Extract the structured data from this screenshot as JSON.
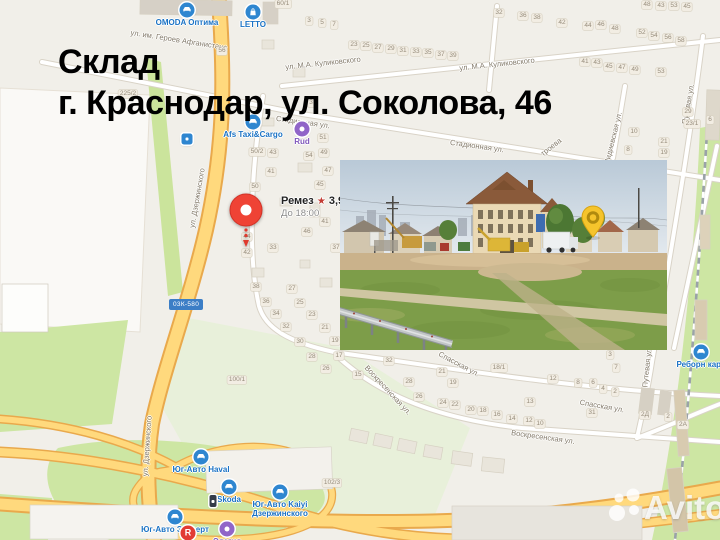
{
  "title": {
    "line1": "Склад",
    "line2": "г. Краснодар, ул. Соколова, 46"
  },
  "watermark": {
    "brand": "Avito"
  },
  "map": {
    "road_badge": "03К-580",
    "pin": {
      "name": "Ремез",
      "star": "★",
      "rating": "3,9",
      "hours": "До 18:00"
    },
    "colors": {
      "title": "#000000",
      "pin_red": "#ef4335",
      "poi_blue": "#2e86d0",
      "poi_purple": "#9065c8",
      "poi_red": "#e23b33",
      "stop_dark": "#333c49",
      "road_yellow": "#ffd97d",
      "road_casing": "#e9a94c",
      "green": "#cde6a3",
      "green_pale": "#e8f0da",
      "badge_blue": "#3c7ec6",
      "building": "#e9e5db"
    },
    "street_labels": [
      {
        "text": "ул. им. Героев Афганистана",
        "x": 179,
        "y": 40,
        "rot": 9
      },
      {
        "text": "ул. М.А. Куликовского",
        "x": 323,
        "y": 63,
        "rot": -6
      },
      {
        "text": "ул. М.А. Куликовского",
        "x": 497,
        "y": 64,
        "rot": -6
      },
      {
        "text": "Стадионная ул.",
        "x": 303,
        "y": 122,
        "rot": 8
      },
      {
        "text": "Стадионная ул.",
        "x": 477,
        "y": 146,
        "rot": 8
      },
      {
        "text": "троева",
        "x": 551,
        "y": 147,
        "rot": -38
      },
      {
        "text": "ул. Дзержинского",
        "x": 197,
        "y": 198,
        "rot": -80
      },
      {
        "text": "ул. Дзержинского",
        "x": 147,
        "y": 446,
        "rot": -86
      },
      {
        "text": "Спасская ул.",
        "x": 459,
        "y": 364,
        "rot": 28
      },
      {
        "text": "Спасская ул.",
        "x": 602,
        "y": 406,
        "rot": 10
      },
      {
        "text": "Воскресенская ул.",
        "x": 388,
        "y": 390,
        "rot": 47
      },
      {
        "text": "Воскресенская ул.",
        "x": 543,
        "y": 437,
        "rot": 8
      },
      {
        "text": "Путевая ул.",
        "x": 688,
        "y": 104,
        "rot": -80
      },
      {
        "text": "Путевая ул.",
        "x": 647,
        "y": 367,
        "rot": -84
      },
      {
        "text": "Лидиевская ул.",
        "x": 613,
        "y": 138,
        "rot": -76
      }
    ],
    "house_numbers": [
      {
        "t": "60/1",
        "x": 283,
        "y": 4
      },
      {
        "t": "56",
        "x": 222,
        "y": 51
      },
      {
        "t": "225/2",
        "x": 128,
        "y": 94
      },
      {
        "t": "3",
        "x": 309,
        "y": 21
      },
      {
        "t": "5",
        "x": 322,
        "y": 23
      },
      {
        "t": "7",
        "x": 334,
        "y": 25
      },
      {
        "t": "23",
        "x": 354,
        "y": 45
      },
      {
        "t": "25",
        "x": 366,
        "y": 46
      },
      {
        "t": "27",
        "x": 378,
        "y": 48
      },
      {
        "t": "29",
        "x": 391,
        "y": 49
      },
      {
        "t": "31",
        "x": 403,
        "y": 51
      },
      {
        "t": "33",
        "x": 416,
        "y": 52
      },
      {
        "t": "35",
        "x": 428,
        "y": 53
      },
      {
        "t": "37",
        "x": 441,
        "y": 55
      },
      {
        "t": "39",
        "x": 453,
        "y": 56
      },
      {
        "t": "32",
        "x": 499,
        "y": 13
      },
      {
        "t": "36",
        "x": 523,
        "y": 16
      },
      {
        "t": "38",
        "x": 537,
        "y": 18
      },
      {
        "t": "42",
        "x": 562,
        "y": 23
      },
      {
        "t": "44",
        "x": 588,
        "y": 26
      },
      {
        "t": "46",
        "x": 601,
        "y": 25
      },
      {
        "t": "48",
        "x": 615,
        "y": 29
      },
      {
        "t": "52",
        "x": 642,
        "y": 33
      },
      {
        "t": "54",
        "x": 654,
        "y": 36
      },
      {
        "t": "56",
        "x": 668,
        "y": 38
      },
      {
        "t": "58",
        "x": 681,
        "y": 41
      },
      {
        "t": "48",
        "x": 647,
        "y": 5
      },
      {
        "t": "43",
        "x": 661,
        "y": 6
      },
      {
        "t": "53",
        "x": 674,
        "y": 6
      },
      {
        "t": "45",
        "x": 687,
        "y": 7
      },
      {
        "t": "41",
        "x": 585,
        "y": 62
      },
      {
        "t": "43",
        "x": 597,
        "y": 63
      },
      {
        "t": "45",
        "x": 609,
        "y": 67
      },
      {
        "t": "47",
        "x": 622,
        "y": 68
      },
      {
        "t": "49",
        "x": 635,
        "y": 70
      },
      {
        "t": "53",
        "x": 661,
        "y": 72
      },
      {
        "t": "29",
        "x": 688,
        "y": 112
      },
      {
        "t": "23/1",
        "x": 692,
        "y": 124
      },
      {
        "t": "10",
        "x": 634,
        "y": 132
      },
      {
        "t": "21",
        "x": 664,
        "y": 142
      },
      {
        "t": "8",
        "x": 628,
        "y": 150
      },
      {
        "t": "19",
        "x": 664,
        "y": 153
      },
      {
        "t": "6",
        "x": 710,
        "y": 120
      },
      {
        "t": "3",
        "x": 311,
        "y": 103
      },
      {
        "t": "50/2",
        "x": 257,
        "y": 152
      },
      {
        "t": "43",
        "x": 273,
        "y": 153
      },
      {
        "t": "41",
        "x": 271,
        "y": 172
      },
      {
        "t": "50",
        "x": 255,
        "y": 187
      },
      {
        "t": "44",
        "x": 247,
        "y": 237
      },
      {
        "t": "42",
        "x": 247,
        "y": 253
      },
      {
        "t": "33",
        "x": 273,
        "y": 248
      },
      {
        "t": "46",
        "x": 307,
        "y": 232
      },
      {
        "t": "41",
        "x": 325,
        "y": 222
      },
      {
        "t": "45",
        "x": 320,
        "y": 185
      },
      {
        "t": "47",
        "x": 328,
        "y": 171
      },
      {
        "t": "49",
        "x": 324,
        "y": 153
      },
      {
        "t": "51",
        "x": 323,
        "y": 138
      },
      {
        "t": "37",
        "x": 336,
        "y": 248
      },
      {
        "t": "54",
        "x": 309,
        "y": 156
      },
      {
        "t": "38",
        "x": 256,
        "y": 287
      },
      {
        "t": "36",
        "x": 266,
        "y": 302
      },
      {
        "t": "34",
        "x": 276,
        "y": 314
      },
      {
        "t": "32",
        "x": 286,
        "y": 327
      },
      {
        "t": "30",
        "x": 300,
        "y": 342
      },
      {
        "t": "28",
        "x": 312,
        "y": 357
      },
      {
        "t": "26",
        "x": 326,
        "y": 369
      },
      {
        "t": "27",
        "x": 292,
        "y": 289
      },
      {
        "t": "25",
        "x": 300,
        "y": 303
      },
      {
        "t": "23",
        "x": 312,
        "y": 315
      },
      {
        "t": "21",
        "x": 325,
        "y": 328
      },
      {
        "t": "19",
        "x": 335,
        "y": 341
      },
      {
        "t": "17",
        "x": 339,
        "y": 356
      },
      {
        "t": "100/1",
        "x": 237,
        "y": 380
      },
      {
        "t": "32",
        "x": 389,
        "y": 361
      },
      {
        "t": "28",
        "x": 409,
        "y": 382
      },
      {
        "t": "26",
        "x": 419,
        "y": 397
      },
      {
        "t": "21",
        "x": 442,
        "y": 372
      },
      {
        "t": "19",
        "x": 453,
        "y": 383
      },
      {
        "t": "24",
        "x": 443,
        "y": 403
      },
      {
        "t": "22",
        "x": 455,
        "y": 405
      },
      {
        "t": "20",
        "x": 471,
        "y": 410
      },
      {
        "t": "18",
        "x": 483,
        "y": 411
      },
      {
        "t": "16",
        "x": 497,
        "y": 415
      },
      {
        "t": "14",
        "x": 512,
        "y": 419
      },
      {
        "t": "12",
        "x": 529,
        "y": 421
      },
      {
        "t": "10",
        "x": 540,
        "y": 424
      },
      {
        "t": "13",
        "x": 530,
        "y": 402
      },
      {
        "t": "15",
        "x": 358,
        "y": 375
      },
      {
        "t": "18/1",
        "x": 499,
        "y": 368
      },
      {
        "t": "12",
        "x": 553,
        "y": 379
      },
      {
        "t": "8",
        "x": 578,
        "y": 383
      },
      {
        "t": "6",
        "x": 593,
        "y": 383
      },
      {
        "t": "4",
        "x": 603,
        "y": 389
      },
      {
        "t": "2",
        "x": 615,
        "y": 392
      },
      {
        "t": "3",
        "x": 610,
        "y": 355
      },
      {
        "t": "7",
        "x": 616,
        "y": 368
      },
      {
        "t": "31",
        "x": 592,
        "y": 413
      },
      {
        "t": "2Д",
        "x": 645,
        "y": 415
      },
      {
        "t": "2",
        "x": 668,
        "y": 417
      },
      {
        "t": "2А",
        "x": 683,
        "y": 425
      },
      {
        "t": "102/3",
        "x": 332,
        "y": 483
      }
    ],
    "pois": [
      {
        "label": "OMODA Оптима",
        "x": 187,
        "y": 10,
        "color": "blue",
        "glyph": "car"
      },
      {
        "label": "LETTO",
        "x": 253,
        "y": 12,
        "color": "blue",
        "glyph": "bag"
      },
      {
        "label": "Afs Taxi&Cargo",
        "x": 253,
        "y": 122,
        "color": "blue",
        "glyph": "car"
      },
      {
        "label": "Rud",
        "x": 302,
        "y": 129,
        "color": "purple",
        "glyph": "dot"
      },
      {
        "label": "Юг-Авто Haval",
        "x": 201,
        "y": 457,
        "color": "blue",
        "glyph": "car"
      },
      {
        "label": "Skoda",
        "x": 229,
        "y": 487,
        "color": "blue",
        "glyph": "car"
      },
      {
        "label": "Юг-Авто Kaiyi",
        "label2": "Дзержинского",
        "x": 280,
        "y": 492,
        "color": "blue",
        "glyph": "car"
      },
      {
        "label": "Юг-Авто Эксперт",
        "x": 175,
        "y": 517,
        "color": "blue",
        "glyph": "car"
      },
      {
        "label": "Элегия",
        "x": 227,
        "y": 529,
        "color": "purple",
        "glyph": "dot"
      },
      {
        "label": "",
        "x": 188,
        "y": 533,
        "color": "red",
        "glyph": "letter-R"
      },
      {
        "label": "Реборн карс",
        "x": 701,
        "y": 352,
        "color": "blue",
        "glyph": "car"
      },
      {
        "label": "",
        "x": 213,
        "y": 501,
        "color": "dark",
        "glyph": "busstop"
      },
      {
        "label": "",
        "x": 187,
        "y": 139,
        "color": "blue",
        "glyph": "transit"
      }
    ]
  }
}
